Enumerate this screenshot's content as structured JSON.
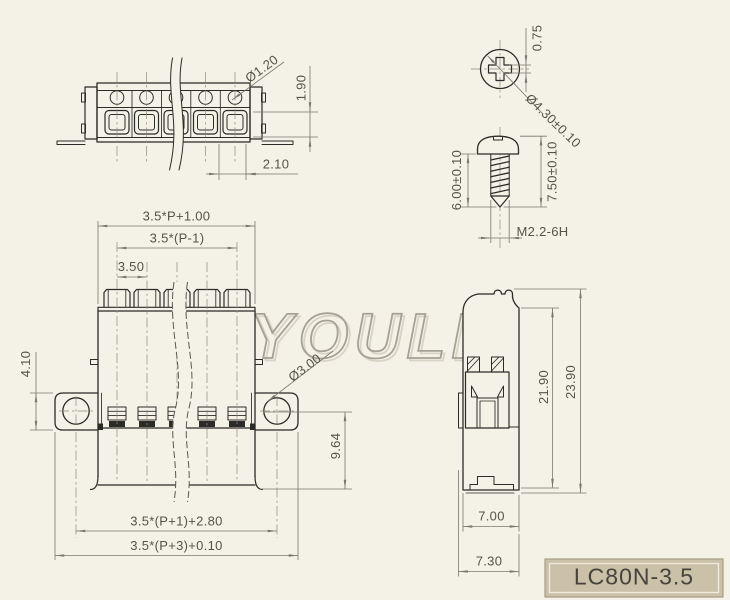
{
  "colors": {
    "background": "#f4f1e6",
    "outline": "#2b2b28",
    "dimension": "#7b786f",
    "centerline": "#8d8a7e",
    "watermark": "#a5a195",
    "title_fill": "#cbc0a8"
  },
  "watermark": {
    "text": "YOULE"
  },
  "title_block": {
    "model": "LC80N-3.5"
  },
  "strip_view": {
    "dims": {
      "wire_hole_dia": "Ø1.20",
      "terminal_depth": "1.90",
      "opening_width": "2.10"
    }
  },
  "screw": {
    "dims": {
      "slot_width": "0.75",
      "head_dia": "Ø4.30±0.10",
      "thread_length": "6.00±0.10",
      "total_length": "7.50±0.10",
      "thread_spec": "M2.2-6H"
    }
  },
  "front_view": {
    "dims": {
      "overall_top": "3.5*P+1.00",
      "pole_span": "3.5*(P-1)",
      "pitch": "3.50",
      "ear_height": "4.10",
      "mount_hole_dia": "Ø3.00",
      "lower_height": "9.64",
      "ear_span": "3.5*(P+1)+2.80",
      "overall_bottom": "3.5*(P+3)+0.10"
    }
  },
  "side_view": {
    "dims": {
      "inner_height": "21.90",
      "overall_height": "23.90",
      "body_width": "7.00",
      "overall_width": "7.30"
    }
  }
}
